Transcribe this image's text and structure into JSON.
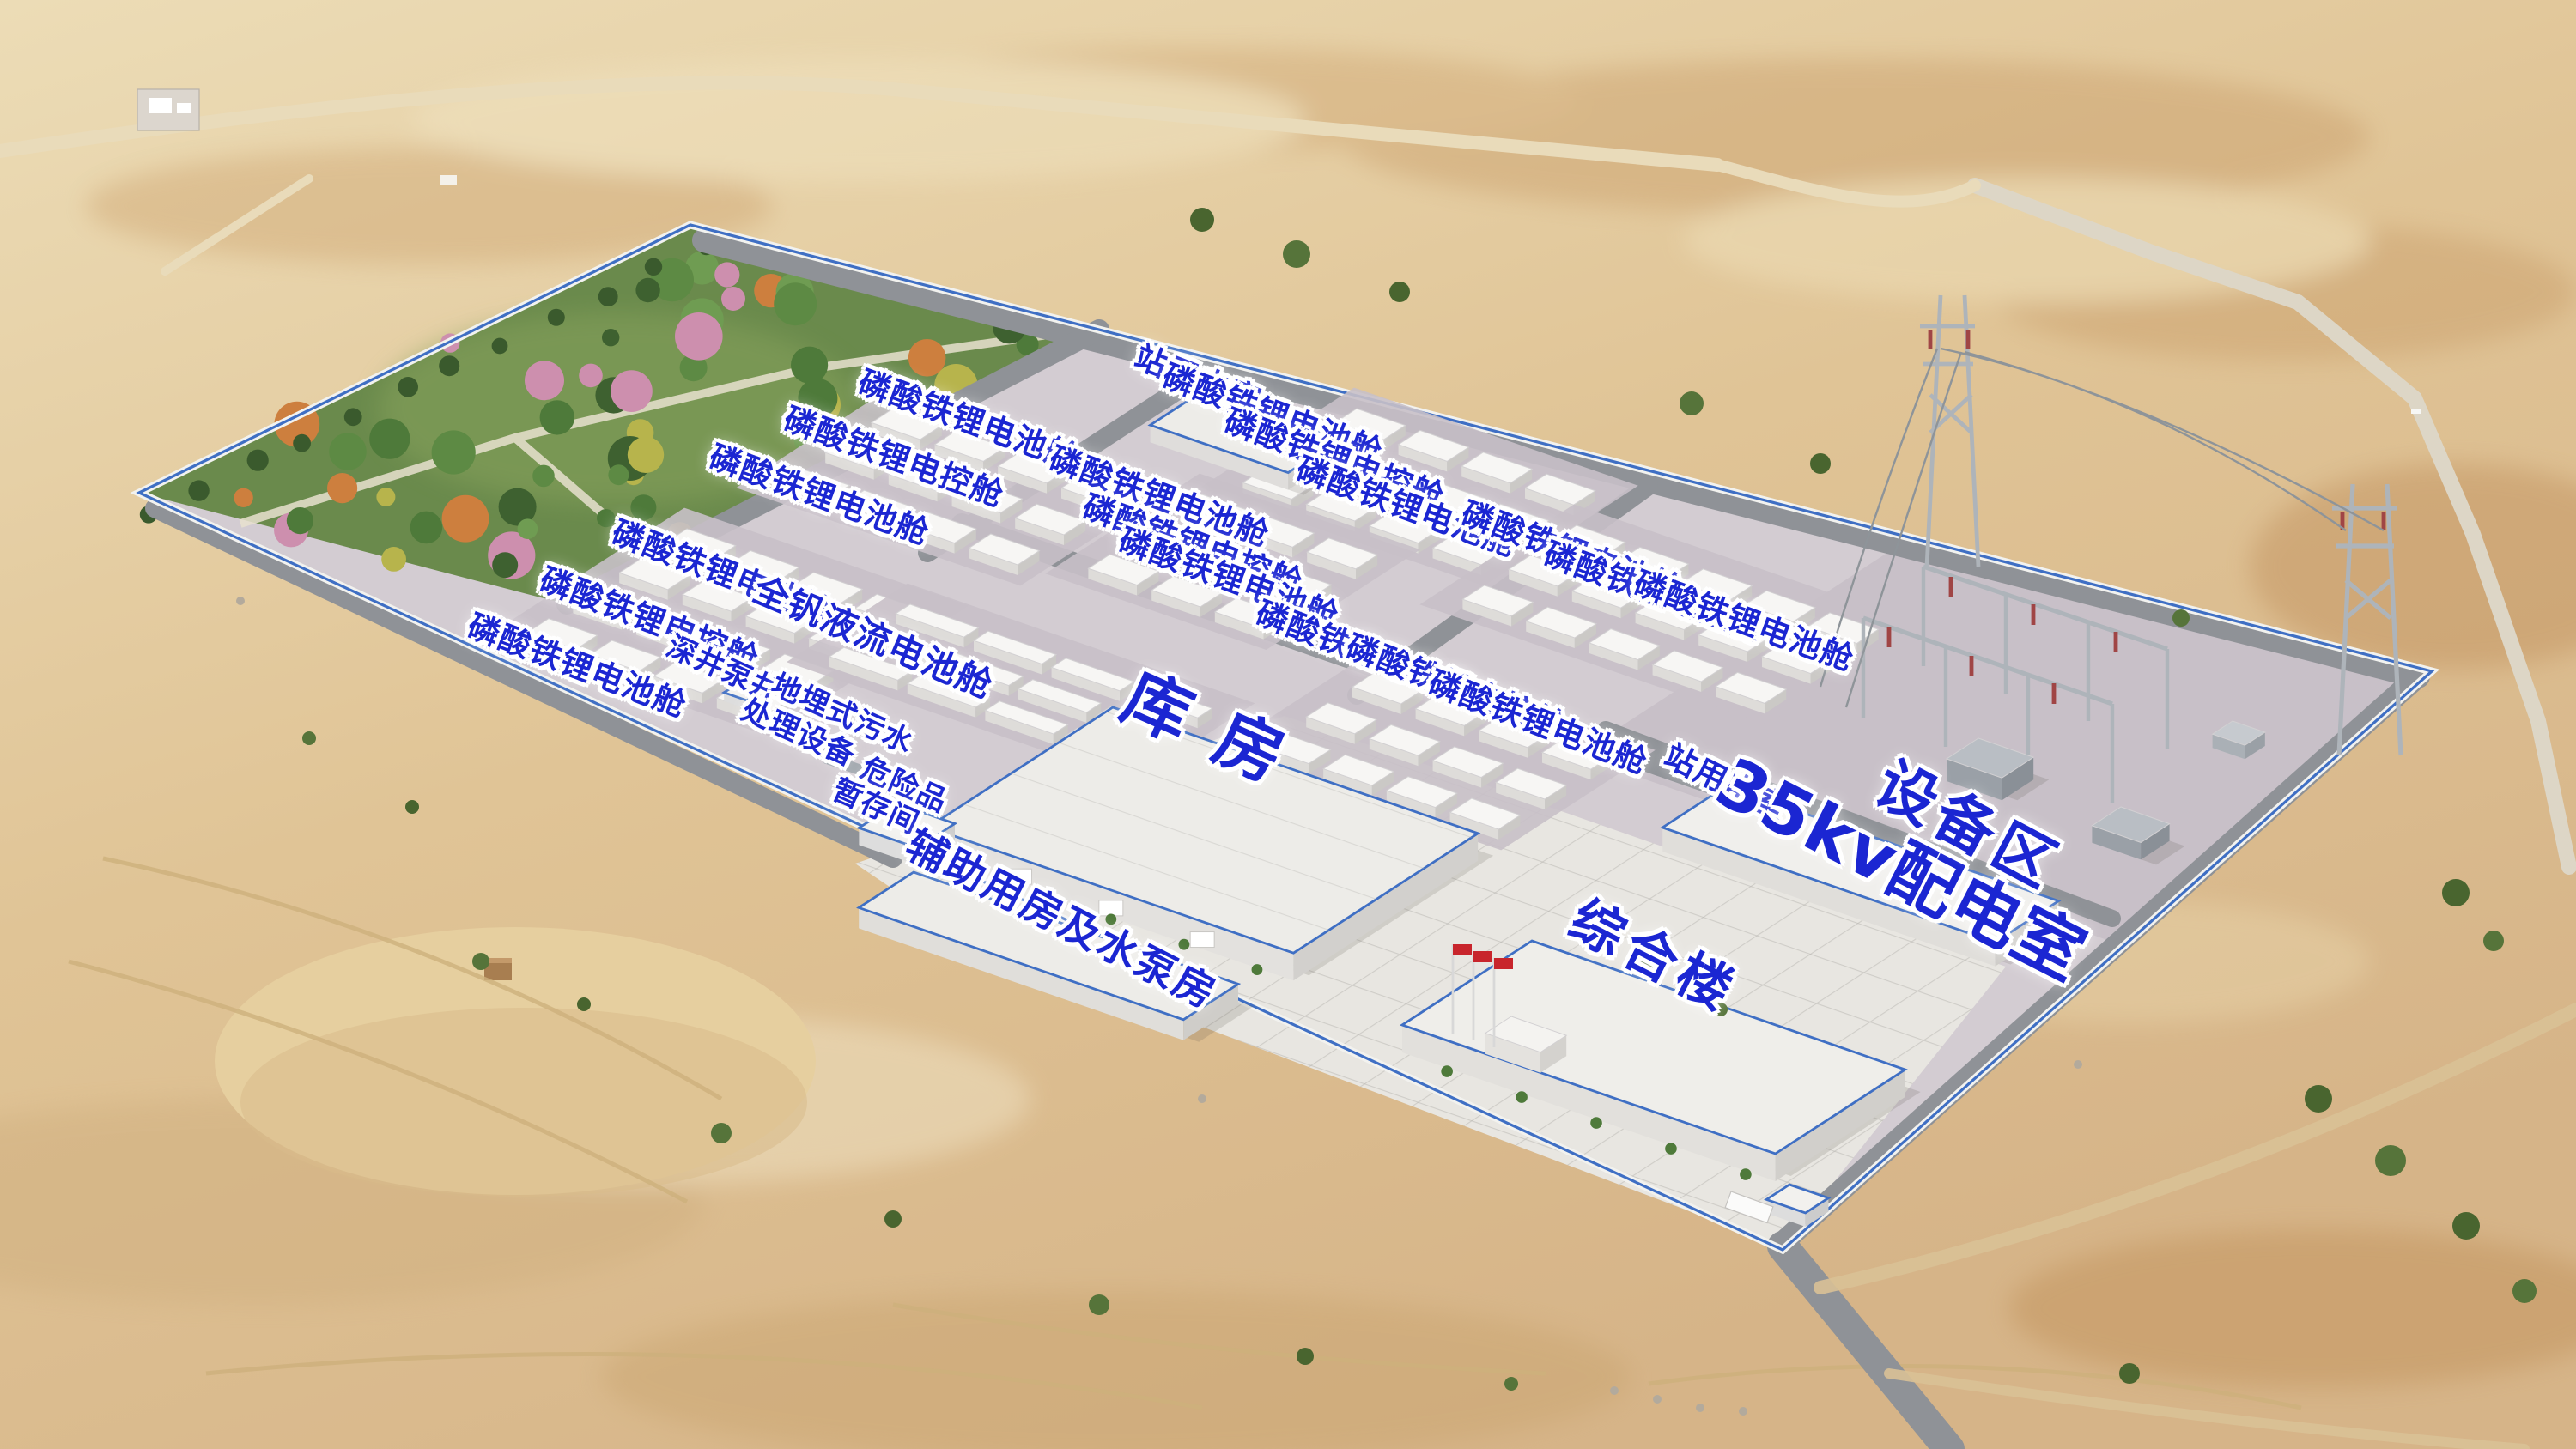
{
  "meta": {
    "scene": "储能电站鸟瞰效果图",
    "type": "aerial-architectural-rendering"
  },
  "colors": {
    "label_blue": "#1b26d2",
    "label_halo": "#ffffff",
    "fence_blue": "#3f6fc4",
    "fence_white": "#f2f2ef",
    "road_gray": "#8f9297",
    "gravel": "#d3ccd2",
    "gravel_dark": "#c8c0c8",
    "plaza": "#e8e6e1",
    "plaza_line": "#b5b3ae",
    "garden_green": "#6a8a4c",
    "sand_light": "#ecdcb6",
    "sand_mid": "#e0c496",
    "sand_deep": "#d6b488",
    "container_roof": "#f7f6f4",
    "container_face": "#dedcd9",
    "container_side": "#cbc9c6",
    "building_roof": "#edece8",
    "flag_red": "#c8252c",
    "steel": "#aeb4ba"
  },
  "labels": [
    {
      "name": "label-station-power-room-north",
      "text": "站用电室",
      "x": 46.5,
      "y": 26.2,
      "rot": 21,
      "size": "s"
    },
    {
      "name": "label-lfp-battery-a1",
      "text": "磷酸铁锂电池舱",
      "x": 28.0,
      "y": 39.5,
      "rot": 21,
      "size": "s"
    },
    {
      "name": "label-lfp-control-a2",
      "text": "磷酸铁锂电控舱",
      "x": 25.2,
      "y": 42.8,
      "rot": 21,
      "size": "s"
    },
    {
      "name": "label-lfp-battery-a3",
      "text": "磷酸铁锂电池舱",
      "x": 22.4,
      "y": 46.0,
      "rot": 21,
      "size": "s"
    },
    {
      "name": "label-lfp-battery-b1",
      "text": "磷酸铁锂电池舱",
      "x": 37.6,
      "y": 29.0,
      "rot": 20,
      "size": "s"
    },
    {
      "name": "label-lfp-control-b2",
      "text": "磷酸铁锂电控舱",
      "x": 34.7,
      "y": 31.6,
      "rot": 20,
      "size": "s"
    },
    {
      "name": "label-lfp-battery-b3",
      "text": "磷酸铁锂电池舱",
      "x": 31.8,
      "y": 34.2,
      "rot": 20,
      "size": "s"
    },
    {
      "name": "label-lfp-battery-c1",
      "text": "磷酸铁锂电池舱",
      "x": 49.4,
      "y": 28.6,
      "rot": 20,
      "size": "s"
    },
    {
      "name": "label-lfp-control-c2",
      "text": "磷酸铁锂电控舱",
      "x": 51.8,
      "y": 31.7,
      "rot": 20,
      "size": "s"
    },
    {
      "name": "label-lfp-battery-c3",
      "text": "磷酸铁锂电池舱",
      "x": 54.6,
      "y": 35.0,
      "rot": 20,
      "size": "s"
    },
    {
      "name": "label-lfp-battery-e1",
      "text": "磷酸铁锂电池舱",
      "x": 45.0,
      "y": 34.3,
      "rot": 20,
      "size": "s"
    },
    {
      "name": "label-lfp-control-e2",
      "text": "磷酸铁锂电控舱",
      "x": 46.3,
      "y": 37.6,
      "rot": 20,
      "size": "s"
    },
    {
      "name": "label-lfp-battery-e3",
      "text": "磷酸铁锂电池舱",
      "x": 47.7,
      "y": 39.9,
      "rot": 20,
      "size": "s"
    },
    {
      "name": "label-lfp-battery-d1",
      "text": "磷酸铁锂电池舱",
      "x": 61.0,
      "y": 38.1,
      "rot": 20,
      "size": "s"
    },
    {
      "name": "label-lfp-control-d2",
      "text": "磷酸铁锂电控舱",
      "x": 64.2,
      "y": 40.9,
      "rot": 20,
      "size": "s"
    },
    {
      "name": "label-lfp-battery-d3",
      "text": "磷酸铁锂电池舱",
      "x": 67.7,
      "y": 42.9,
      "rot": 20,
      "size": "s"
    },
    {
      "name": "label-lfp-battery-g1",
      "text": "磷酸铁锂电池舱",
      "x": 53.0,
      "y": 45.1,
      "rot": 21,
      "size": "s"
    },
    {
      "name": "label-lfp-control-g2",
      "text": "磷酸铁锂电控舱",
      "x": 56.5,
      "y": 47.4,
      "rot": 21,
      "size": "s"
    },
    {
      "name": "label-lfp-battery-g3",
      "text": "磷酸铁锂电池舱",
      "x": 59.7,
      "y": 49.9,
      "rot": 21,
      "size": "s"
    },
    {
      "name": "label-vanadium-flow-battery",
      "text": "全钒液流电池舱",
      "x": 33.9,
      "y": 44.0,
      "rot": 23,
      "size": "m"
    },
    {
      "name": "label-deep-well-pump",
      "text": "深井泵井",
      "x": 28.1,
      "y": 46.2,
      "rot": 24,
      "size": "b"
    },
    {
      "name": "label-buried-sewage-line1",
      "text": "地埋式污水",
      "x": 32.7,
      "y": 49.3,
      "rot": 24,
      "size": "b"
    },
    {
      "name": "label-buried-sewage-line2",
      "text": "处理设备",
      "x": 31.0,
      "y": 50.6,
      "rot": 24,
      "size": "b"
    },
    {
      "name": "label-hazmat-line1",
      "text": "危险品",
      "x": 35.1,
      "y": 54.2,
      "rot": 24,
      "size": "b"
    },
    {
      "name": "label-hazmat-line2",
      "text": "暂存间",
      "x": 34.0,
      "y": 55.7,
      "rot": 24,
      "size": "b"
    },
    {
      "name": "label-aux-pump-house",
      "text": "辅助用房及水泵房",
      "x": 41.2,
      "y": 63.5,
      "rot": 27,
      "size": "d"
    },
    {
      "name": "label-warehouse",
      "text": "库房",
      "x": 47.3,
      "y": 50.7,
      "rot": 24,
      "size": "wh"
    },
    {
      "name": "label-complex-building",
      "text": "综合楼",
      "x": 64.2,
      "y": 66.0,
      "rot": 27,
      "size": "e"
    },
    {
      "name": "label-station-power-room-35kv",
      "text": "站用电室",
      "x": 67.0,
      "y": 54.0,
      "rot": 26,
      "size": "s"
    },
    {
      "name": "label-35kv-distribution-room",
      "text": "35kv配电室",
      "x": 73.8,
      "y": 60.0,
      "rot": 27,
      "size": "f"
    },
    {
      "name": "label-equipment-area",
      "text": "设备区",
      "x": 76.4,
      "y": 57.0,
      "rot": 28,
      "size": "g"
    }
  ],
  "clusters": [
    {
      "name": "cluster-lfp-a",
      "anchor": [
        400,
        308
      ],
      "cols": 4,
      "rows": 4,
      "cw": 30,
      "ch": 15,
      "gx": 9,
      "gy": 17,
      "kind": "lfp"
    },
    {
      "name": "cluster-lfp-b",
      "anchor": [
        520,
        238
      ],
      "cols": 4,
      "rows": 3,
      "cw": 30,
      "ch": 15,
      "gx": 9,
      "gy": 17,
      "kind": "lfp"
    },
    {
      "name": "cluster-lfp-c",
      "anchor": [
        790,
        238
      ],
      "cols": 4,
      "rows": 3,
      "cw": 30,
      "ch": 15,
      "gx": 9,
      "gy": 17,
      "kind": "lfp"
    },
    {
      "name": "cluster-lfp-e",
      "anchor": [
        700,
        288
      ],
      "cols": 3,
      "rows": 3,
      "cw": 30,
      "ch": 15,
      "gx": 9,
      "gy": 17,
      "kind": "lfp"
    },
    {
      "name": "cluster-lfp-d",
      "anchor": [
        918,
        306
      ],
      "cols": 5,
      "rows": 3,
      "cw": 30,
      "ch": 15,
      "gx": 9,
      "gy": 17,
      "kind": "lfp"
    },
    {
      "name": "cluster-lfp-g",
      "anchor": [
        800,
        392
      ],
      "cols": 4,
      "rows": 3,
      "cw": 30,
      "ch": 15,
      "gx": 9,
      "gy": 17,
      "kind": "lfp"
    },
    {
      "name": "cluster-vanadium",
      "anchor": [
        530,
        352
      ],
      "cols": 4,
      "rows": 3,
      "cw": 42,
      "ch": 10,
      "gx": 6,
      "gy": 13,
      "kind": "vrfb"
    }
  ]
}
